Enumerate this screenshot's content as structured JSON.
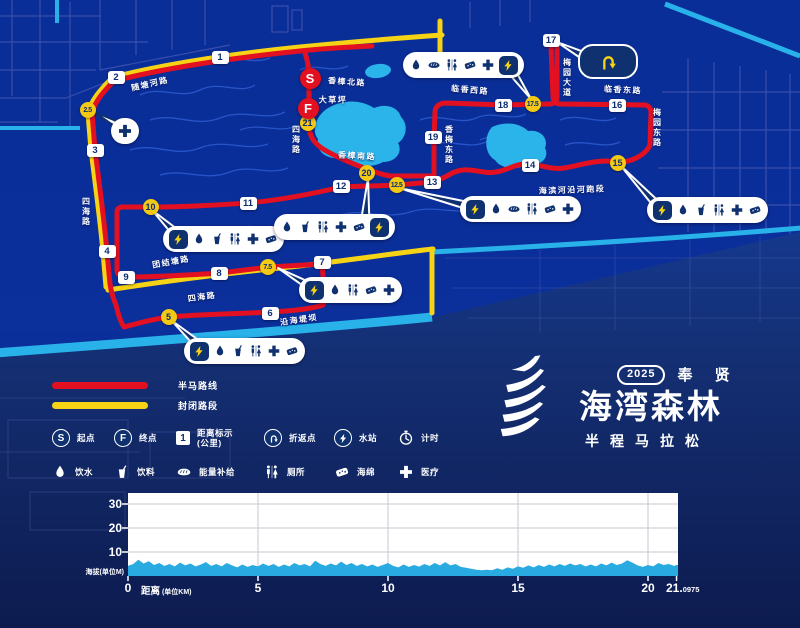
{
  "map": {
    "colors": {
      "route_red": "#e31021",
      "route_yellow": "#f6d315",
      "water_cyan": "#29b2e9",
      "marker_navy": "#10316f",
      "bg_blue": "#0b2f9b"
    },
    "start_marker": {
      "label": "S",
      "x": 310,
      "y": 78
    },
    "finish_marker": {
      "label": "F",
      "x": 308,
      "y": 108
    },
    "km_markers": [
      {
        "n": "1",
        "t": "sq",
        "x": 220,
        "y": 57
      },
      {
        "n": "2",
        "t": "sq",
        "x": 116,
        "y": 77
      },
      {
        "n": "2.5",
        "t": "c",
        "x": 88,
        "y": 110
      },
      {
        "n": "3",
        "t": "sq",
        "x": 95,
        "y": 150
      },
      {
        "n": "4",
        "t": "sq",
        "x": 107,
        "y": 251
      },
      {
        "n": "5",
        "t": "c",
        "x": 169,
        "y": 317
      },
      {
        "n": "6",
        "t": "sq",
        "x": 270,
        "y": 313
      },
      {
        "n": "7",
        "t": "sq",
        "x": 322,
        "y": 262
      },
      {
        "n": "7.5",
        "t": "c",
        "x": 268,
        "y": 267
      },
      {
        "n": "8",
        "t": "sq",
        "x": 219,
        "y": 273
      },
      {
        "n": "9",
        "t": "sq",
        "x": 126,
        "y": 277
      },
      {
        "n": "10",
        "t": "c",
        "x": 151,
        "y": 207
      },
      {
        "n": "11",
        "t": "sq",
        "x": 248,
        "y": 203
      },
      {
        "n": "12",
        "t": "sq",
        "x": 341,
        "y": 186
      },
      {
        "n": "12.5",
        "t": "c",
        "x": 397,
        "y": 185
      },
      {
        "n": "13",
        "t": "sq",
        "x": 432,
        "y": 182
      },
      {
        "n": "14",
        "t": "sq",
        "x": 530,
        "y": 165
      },
      {
        "n": "15",
        "t": "c",
        "x": 618,
        "y": 163
      },
      {
        "n": "16",
        "t": "sq",
        "x": 617,
        "y": 105
      },
      {
        "n": "17",
        "t": "sq",
        "x": 551,
        "y": 40
      },
      {
        "n": "17.5",
        "t": "c",
        "x": 533,
        "y": 104
      },
      {
        "n": "18",
        "t": "sq",
        "x": 503,
        "y": 105
      },
      {
        "n": "19",
        "t": "sq",
        "x": 433,
        "y": 137
      },
      {
        "n": "20",
        "t": "c",
        "x": 367,
        "y": 173
      },
      {
        "n": "21",
        "t": "c",
        "x": 308,
        "y": 123
      }
    ],
    "road_labels": [
      {
        "text": "随塘河路",
        "x": 150,
        "y": 84,
        "r": -13
      },
      {
        "text": "香樟北路",
        "x": 347,
        "y": 82,
        "r": 4
      },
      {
        "text": "大草坪",
        "x": 333,
        "y": 100,
        "r": 0
      },
      {
        "text": "四海路",
        "x": 296,
        "y": 140,
        "v": 1
      },
      {
        "text": "香樟南路",
        "x": 357,
        "y": 156,
        "r": 3
      },
      {
        "text": "临香西路",
        "x": 470,
        "y": 90,
        "r": 5
      },
      {
        "text": "梅园大道",
        "x": 567,
        "y": 78,
        "v": 1
      },
      {
        "text": "临香东路",
        "x": 623,
        "y": 90,
        "r": 3
      },
      {
        "text": "梅园东路",
        "x": 657,
        "y": 128,
        "v": 1
      },
      {
        "text": "香梅东路",
        "x": 449,
        "y": 145,
        "v": 1
      },
      {
        "text": "海滨河沿河跑段",
        "x": 572,
        "y": 190,
        "r": -2
      },
      {
        "text": "四海路",
        "x": 86,
        "y": 212,
        "v": 1
      },
      {
        "text": "团结塘路",
        "x": 171,
        "y": 262,
        "r": -10
      },
      {
        "text": "四海路",
        "x": 202,
        "y": 297,
        "r": -8
      },
      {
        "text": "沿海堤坝",
        "x": 299,
        "y": 320,
        "r": -8
      }
    ],
    "callouts": [
      {
        "id": "aid-2p5km",
        "x": 111,
        "y": 118,
        "icons": [
          "cross"
        ],
        "bolt": "none",
        "tail": {
          "tip": [
            94,
            112
          ],
          "base": [
            122,
            127
          ],
          "w": 7,
          "light": 1
        }
      },
      {
        "id": "station-5km",
        "x": 184,
        "y": 338,
        "icons": [
          "drop",
          "cup",
          "toilet",
          "cross",
          "sponge"
        ],
        "bolt": "left",
        "tail": {
          "tip": [
            171,
            320
          ],
          "base": [
            200,
            346
          ],
          "w": 8
        }
      },
      {
        "id": "station-7p5km",
        "x": 299,
        "y": 277,
        "icons": [
          "drop",
          "toilet",
          "sponge",
          "cross"
        ],
        "bolt": "left",
        "tail": {
          "tip": [
            278,
            268
          ],
          "base": [
            313,
            288
          ],
          "w": 8
        }
      },
      {
        "id": "station-10km",
        "x": 163,
        "y": 226,
        "icons": [
          "drop",
          "cup",
          "toilet",
          "cross",
          "sponge"
        ],
        "bolt": "left",
        "tail": {
          "tip": [
            152,
            210
          ],
          "base": [
            177,
            234
          ],
          "w": 8
        }
      },
      {
        "id": "station-12p5km",
        "x": 460,
        "y": 196,
        "icons": [
          "drop",
          "bread",
          "toilet",
          "sponge",
          "cross"
        ],
        "bolt": "left",
        "tail": {
          "tip": [
            399,
            188
          ],
          "base": [
            473,
            207
          ],
          "w": 8
        }
      },
      {
        "id": "station-15km",
        "x": 647,
        "y": 197,
        "icons": [
          "drop",
          "cup",
          "toilet",
          "cross",
          "sponge"
        ],
        "bolt": "left",
        "tail": {
          "tip": [
            621,
            166
          ],
          "base": [
            660,
            208
          ],
          "w": 8
        }
      },
      {
        "id": "station-17p5km",
        "x": 403,
        "y": 52,
        "icons": [
          "drop",
          "bread",
          "toilet",
          "sponge",
          "cross"
        ],
        "bolt": "right",
        "tail": {
          "tip": [
            531,
            99
          ],
          "base": [
            508,
            66
          ],
          "w": 9
        }
      },
      {
        "id": "station-20km",
        "x": 274,
        "y": 214,
        "icons": [
          "drop",
          "cup",
          "toilet",
          "cross",
          "sponge"
        ],
        "bolt": "right",
        "tail": {
          "tip": [
            368,
            178
          ],
          "base": [
            365,
            224
          ],
          "w": 9
        }
      }
    ],
    "uturn_callout": {
      "x": 578,
      "y": 44,
      "w": 56,
      "h": 31,
      "tail": {
        "tip": [
          557,
          42
        ],
        "base": [
          586,
          57
        ],
        "w": 8
      }
    }
  },
  "legend": {
    "lines": [
      {
        "label": "半马路线",
        "color": "#e31021",
        "name": "half-marathon-route"
      },
      {
        "label": "封闭路段",
        "color": "#f6d315",
        "name": "closed-section"
      }
    ],
    "rows": [
      [
        {
          "icon": "badge-s",
          "label": "起点",
          "name": "start-point"
        },
        {
          "icon": "badge-f",
          "label": "终点",
          "name": "finish-point"
        },
        {
          "icon": "badge-1",
          "label": "距离标示\n(公里)",
          "name": "distance-marking-km"
        },
        {
          "icon": "uturn",
          "label": "折返点",
          "name": "turnaround-point"
        },
        {
          "icon": "bolt",
          "label": "水站",
          "name": "water-station"
        },
        {
          "icon": "clock",
          "label": "计时",
          "name": "timing"
        }
      ],
      [
        {
          "icon": "drop",
          "label": "饮水",
          "name": "drinking-water"
        },
        {
          "icon": "cup",
          "label": "饮料",
          "name": "beverage"
        },
        {
          "icon": "bread",
          "label": "能量补给",
          "name": "energy-supply"
        },
        {
          "icon": "toilet",
          "label": "厕所",
          "name": "toilet"
        },
        {
          "icon": "sponge",
          "label": "海绵",
          "name": "sponge"
        },
        {
          "icon": "cross",
          "label": "医疗",
          "name": "medical"
        }
      ]
    ],
    "col_widths": [
      62,
      62,
      88,
      70,
      64,
      54
    ]
  },
  "logo": {
    "year": "2025",
    "region": "奉 贤",
    "title": "海湾森林",
    "subtitle": "半程马拉松"
  },
  "chart_data": {
    "type": "area",
    "title": "",
    "ylabel": "海拔(单位M)",
    "xlabel": "距离",
    "xlabel_unit": "(单位KM)",
    "yticks": [
      10,
      20,
      30
    ],
    "xticks": [
      0,
      5,
      10,
      15,
      20
    ],
    "x_final": 21.0975,
    "x_final_main": "21.",
    "x_final_sub": "0975",
    "ylim": [
      0,
      34.5
    ],
    "xlim": [
      0,
      21.4
    ],
    "grid": true,
    "legend_position": "none",
    "fill_color": "#29abe2",
    "points": [
      [
        0,
        4.2
      ],
      [
        0.2,
        5.0
      ],
      [
        0.4,
        6.8
      ],
      [
        0.6,
        5.2
      ],
      [
        0.8,
        6.2
      ],
      [
        1.0,
        4.6
      ],
      [
        1.2,
        5.4
      ],
      [
        1.4,
        4.2
      ],
      [
        1.6,
        5.0
      ],
      [
        1.8,
        4.0
      ],
      [
        2.0,
        5.6
      ],
      [
        2.2,
        4.4
      ],
      [
        2.4,
        5.2
      ],
      [
        2.6,
        4.0
      ],
      [
        2.8,
        4.8
      ],
      [
        3.0,
        5.8
      ],
      [
        3.2,
        4.2
      ],
      [
        3.4,
        5.0
      ],
      [
        3.6,
        4.0
      ],
      [
        3.8,
        5.4
      ],
      [
        4.0,
        4.4
      ],
      [
        4.2,
        3.6
      ],
      [
        4.4,
        4.8
      ],
      [
        4.6,
        3.8
      ],
      [
        4.8,
        4.6
      ],
      [
        5.0,
        4.0
      ],
      [
        5.2,
        5.2
      ],
      [
        5.4,
        4.2
      ],
      [
        5.6,
        5.0
      ],
      [
        5.8,
        3.8
      ],
      [
        6.0,
        4.8
      ],
      [
        6.2,
        4.0
      ],
      [
        6.4,
        5.4
      ],
      [
        6.6,
        4.4
      ],
      [
        6.8,
        5.0
      ],
      [
        7.0,
        4.0
      ],
      [
        7.2,
        6.4
      ],
      [
        7.4,
        5.0
      ],
      [
        7.6,
        4.2
      ],
      [
        7.8,
        5.2
      ],
      [
        8.0,
        4.4
      ],
      [
        8.2,
        6.0
      ],
      [
        8.4,
        4.6
      ],
      [
        8.6,
        5.4
      ],
      [
        8.8,
        4.2
      ],
      [
        9.0,
        5.0
      ],
      [
        9.2,
        4.0
      ],
      [
        9.4,
        4.8
      ],
      [
        9.6,
        3.8
      ],
      [
        9.8,
        4.6
      ],
      [
        10.0,
        5.4
      ],
      [
        10.2,
        4.2
      ],
      [
        10.4,
        3.6
      ],
      [
        10.6,
        4.8
      ],
      [
        10.8,
        3.8
      ],
      [
        11.0,
        4.6
      ],
      [
        11.2,
        3.9
      ],
      [
        11.4,
        5.0
      ],
      [
        11.6,
        4.2
      ],
      [
        11.8,
        5.4
      ],
      [
        12.0,
        4.4
      ],
      [
        12.2,
        5.8
      ],
      [
        12.4,
        4.4
      ],
      [
        12.6,
        5.0
      ],
      [
        12.8,
        3.8
      ],
      [
        13.0,
        3.4
      ],
      [
        13.2,
        3.0
      ],
      [
        13.4,
        2.6
      ],
      [
        13.6,
        2.4
      ],
      [
        13.8,
        2.6
      ],
      [
        14.0,
        2.4
      ],
      [
        14.2,
        3.2
      ],
      [
        14.4,
        2.6
      ],
      [
        14.6,
        3.6
      ],
      [
        14.8,
        3.0
      ],
      [
        15.0,
        4.0
      ],
      [
        15.2,
        3.4
      ],
      [
        15.4,
        4.4
      ],
      [
        15.6,
        3.6
      ],
      [
        15.8,
        4.6
      ],
      [
        16.0,
        3.8
      ],
      [
        16.2,
        4.8
      ],
      [
        16.4,
        4.0
      ],
      [
        16.6,
        5.0
      ],
      [
        16.8,
        4.2
      ],
      [
        17.0,
        5.2
      ],
      [
        17.2,
        4.4
      ],
      [
        17.4,
        5.0
      ],
      [
        17.6,
        4.0
      ],
      [
        17.8,
        4.8
      ],
      [
        18.0,
        4.0
      ],
      [
        18.2,
        5.2
      ],
      [
        18.4,
        4.4
      ],
      [
        18.6,
        5.6
      ],
      [
        18.8,
        4.6
      ],
      [
        19.0,
        5.2
      ],
      [
        19.2,
        6.6
      ],
      [
        19.4,
        5.6
      ],
      [
        19.6,
        4.4
      ],
      [
        19.8,
        3.8
      ],
      [
        20.0,
        4.6
      ],
      [
        20.2,
        4.0
      ],
      [
        20.4,
        5.4
      ],
      [
        20.6,
        4.6
      ],
      [
        20.8,
        5.0
      ],
      [
        21.0,
        4.2
      ],
      [
        21.0975,
        4.6
      ]
    ]
  }
}
